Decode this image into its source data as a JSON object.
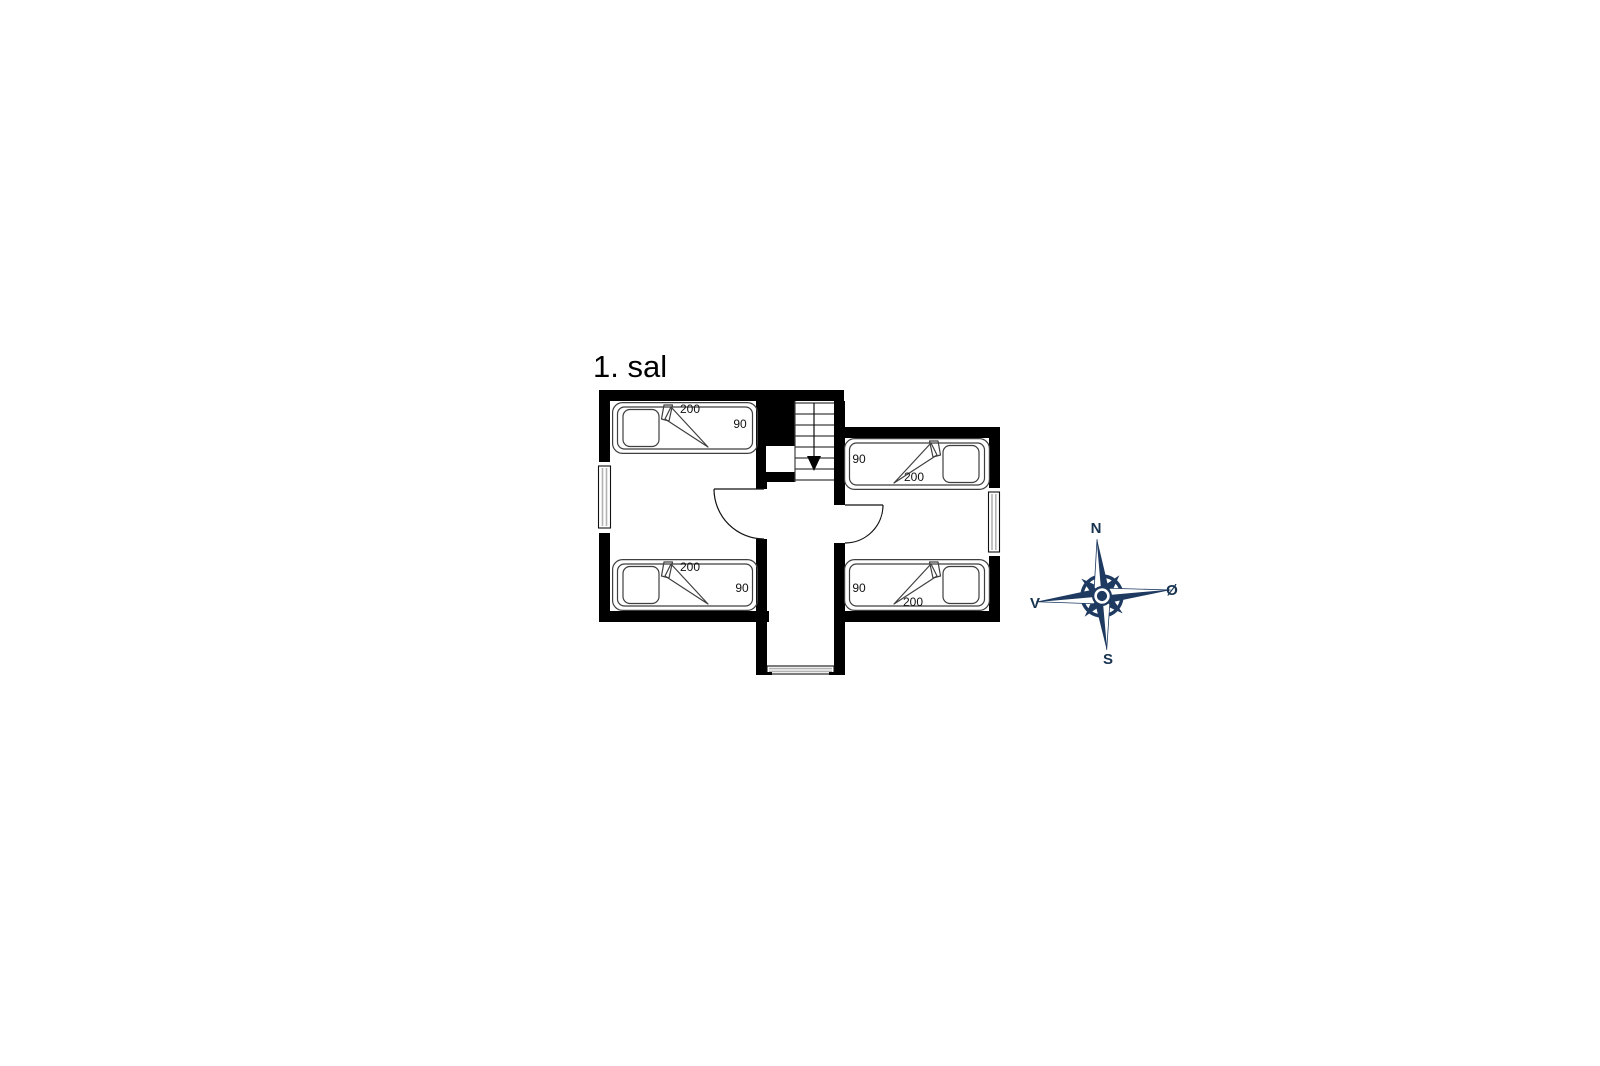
{
  "page": {
    "background": "#ffffff"
  },
  "floorplan": {
    "title": "1. sal",
    "beds": [
      {
        "room": "left",
        "position": "top",
        "length": "200",
        "width": "90"
      },
      {
        "room": "left",
        "position": "bottom",
        "length": "200",
        "width": "90"
      },
      {
        "room": "right",
        "position": "top",
        "length": "200",
        "width": "90"
      },
      {
        "room": "right",
        "position": "bottom",
        "length": "200",
        "width": "90"
      }
    ],
    "stairs": {
      "direction_icon": "down-arrow"
    },
    "colors": {
      "wall": "#000000",
      "furniture_line": "#3f3f3f",
      "window_line": "#b3b3b3",
      "text": "#111111"
    }
  },
  "compass": {
    "icon": "compass-rose",
    "color": "#1e3a60",
    "labels": {
      "north": "N",
      "east": "Ø",
      "south": "S",
      "west": "V"
    }
  }
}
